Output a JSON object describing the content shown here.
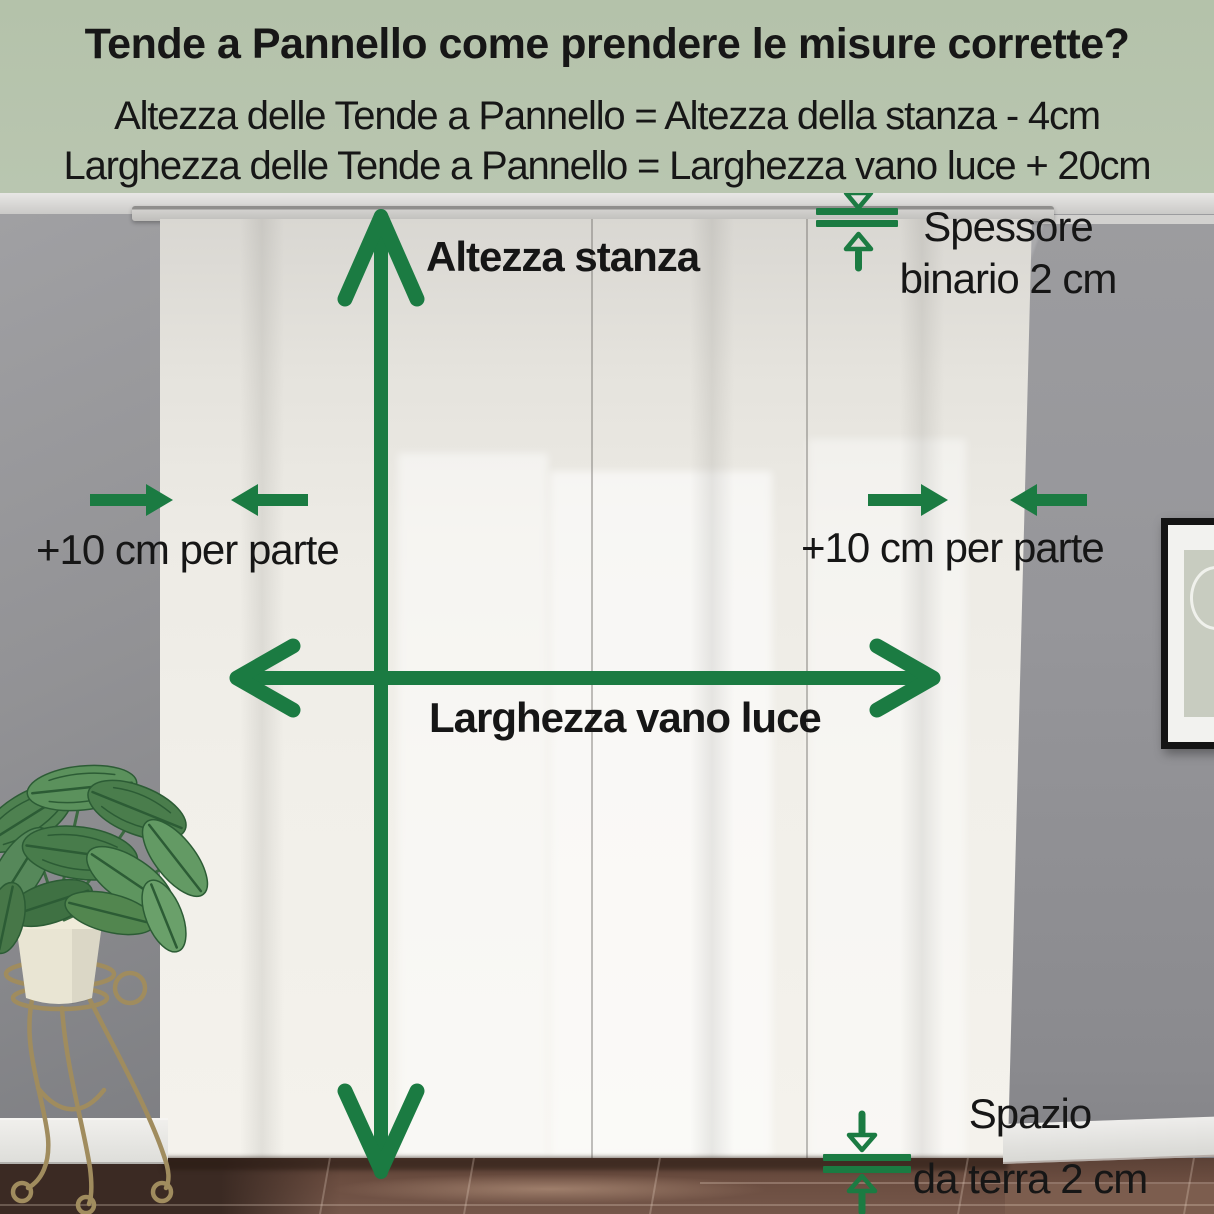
{
  "colors": {
    "accent_green": "#1B7B42",
    "header_bg": "#B6C3AC",
    "text": "#171717",
    "curtain": "#F1EFE9",
    "wall_gray": "#939396",
    "floor_brown": "#6B4D40"
  },
  "header": {
    "title": "Tende a Pannello come prendere le misure corrette?",
    "formula_height": "Altezza delle Tende a Pannello = Altezza della stanza - 4cm",
    "formula_width": "Larghezza delle Tende a Pannello = Larghezza vano luce + 20cm"
  },
  "labels": {
    "room_height": "Altezza stanza",
    "opening_width": "Larghezza vano luce",
    "side_margin_left": "+10 cm per parte",
    "side_margin_right": "+10 cm per parte",
    "track_line1": "Spessore",
    "track_line2": "binario 2 cm",
    "floor_gap_line1": "Spazio",
    "floor_gap_line2": "da terra 2 cm"
  },
  "icons": {
    "room_height_arrow": "vertical-double-arrow",
    "opening_width_arrow": "horizontal-double-arrow",
    "side_margin_arrows_left": "converging-arrows",
    "side_margin_arrows_right": "converging-arrows",
    "track_thickness_gauge": "double-line-with-arrows",
    "floor_gap_gauge": "double-line-with-arrows"
  }
}
